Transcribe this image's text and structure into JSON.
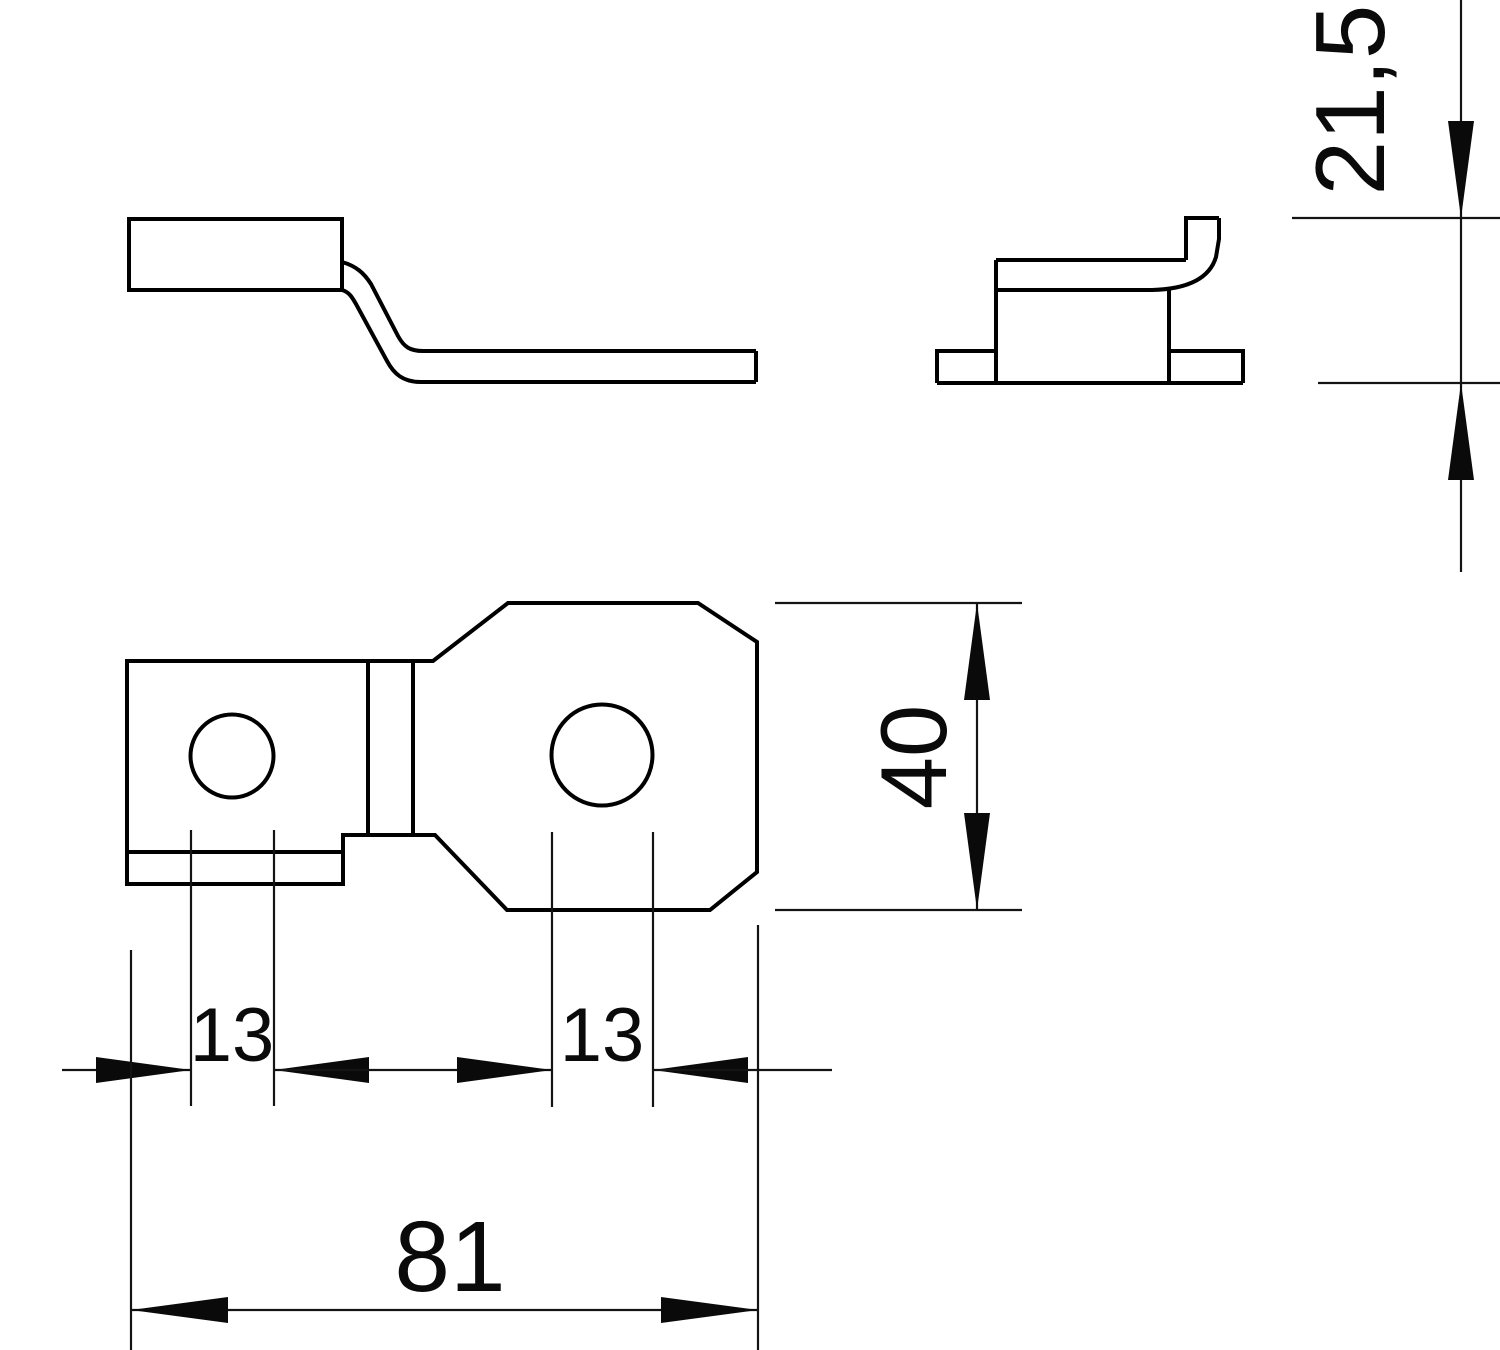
{
  "drawing": {
    "background_color": "#ffffff",
    "outline_color": "#000000",
    "dimension_line_color": "#141414",
    "dimensions": {
      "height": {
        "label": "21,5"
      },
      "plate_width": {
        "label": "40"
      },
      "hole_left": {
        "label": "13"
      },
      "hole_right": {
        "label": "13"
      },
      "overall_length": {
        "label": "81"
      }
    }
  }
}
